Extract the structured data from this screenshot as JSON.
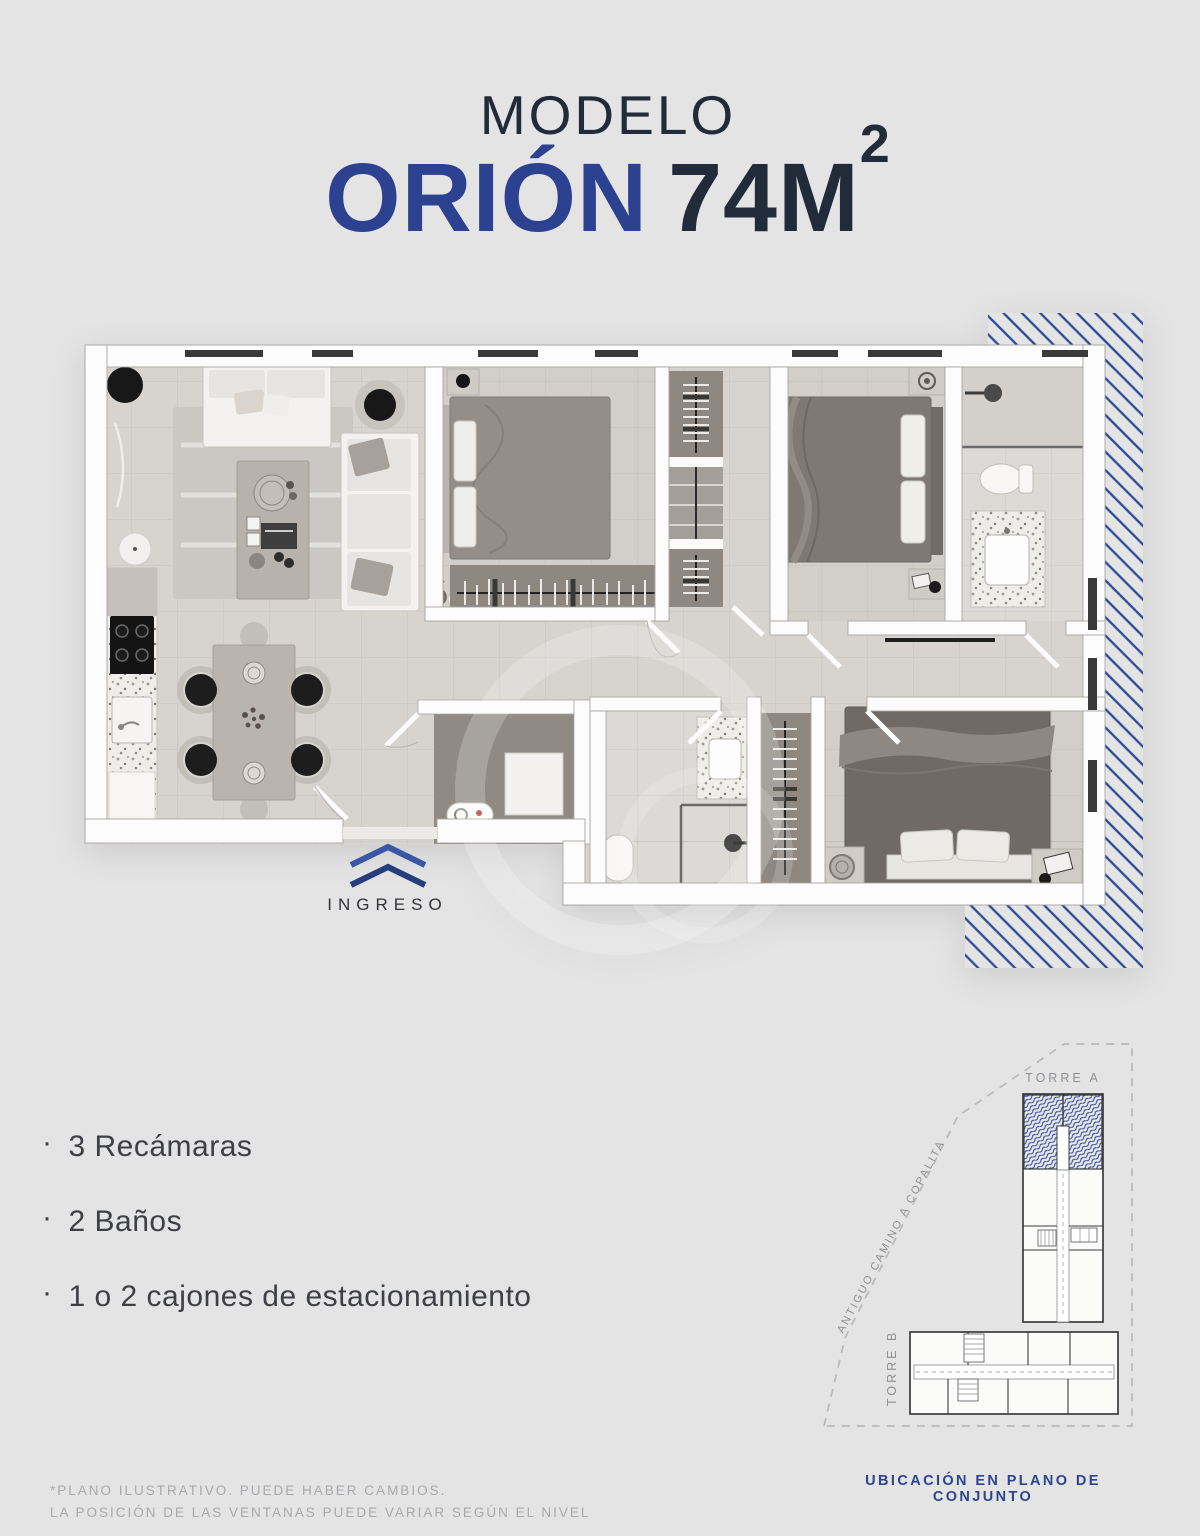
{
  "title": {
    "pretitle": "MODELO",
    "model_name": "ORIÓN",
    "area": "74M",
    "area_exponent": "2"
  },
  "entry": {
    "label": "INGRESO"
  },
  "features": {
    "items": [
      {
        "bullet": "·",
        "text": "3 Recámaras"
      },
      {
        "bullet": "·",
        "text": "2 Baños"
      },
      {
        "bullet": "·",
        "text": "1 o 2 cajones de estacionamiento"
      }
    ]
  },
  "sitemap": {
    "tower_a_label": "TORRE A",
    "tower_b_label": "TORRE B",
    "road_label": "ANTIGUO CAMINO A COPALITA",
    "caption": "UBICACIÓN EN PLANO DE CONJUNTO"
  },
  "disclaimer": {
    "line1": "*PLANO ILUSTRATIVO. PUEDE HABER CAMBIOS.",
    "line2": "LA POSICIÓN DE LAS VENTANAS PUEDE VARIAR SEGÚN EL NIVEL"
  },
  "colors": {
    "brand-blue": "#2d4191",
    "dark-navy": "#212b3a",
    "hatch-blue": "#2d4a96",
    "caption-blue": "#2b4590",
    "feature-text": "#3e4045",
    "muted-gray": "#a9a9ac",
    "map-gray": "#8f9093",
    "background": "#e4e4e5"
  }
}
